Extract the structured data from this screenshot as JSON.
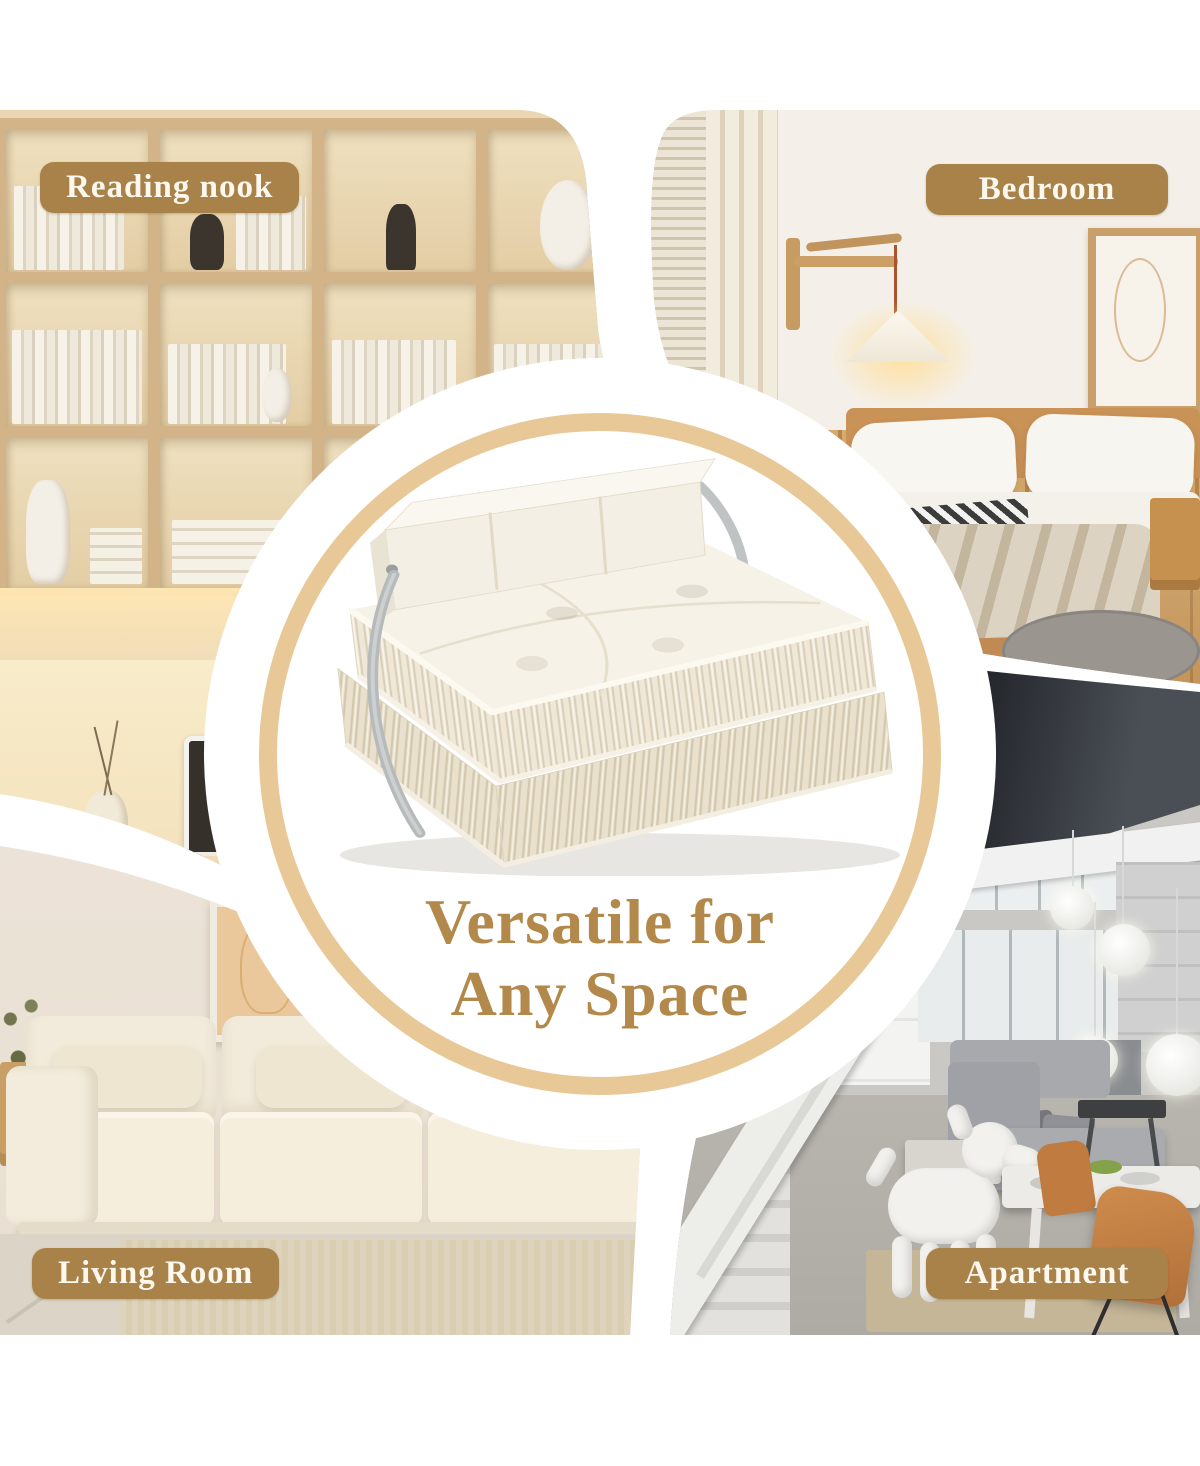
{
  "headline": {
    "line1": "Versatile for",
    "line2": "Any Space"
  },
  "badges": {
    "reading_nook": "Reading nook",
    "bedroom": "Bedroom",
    "living_room": "Living Room",
    "apartment": "Apartment"
  },
  "colors": {
    "badge_background": "#a9824a",
    "badge_text": "#fcf8ee",
    "headline_text": "#b2894a",
    "circle_ring_gold": "#e9c897",
    "page_background": "#ffffff"
  }
}
